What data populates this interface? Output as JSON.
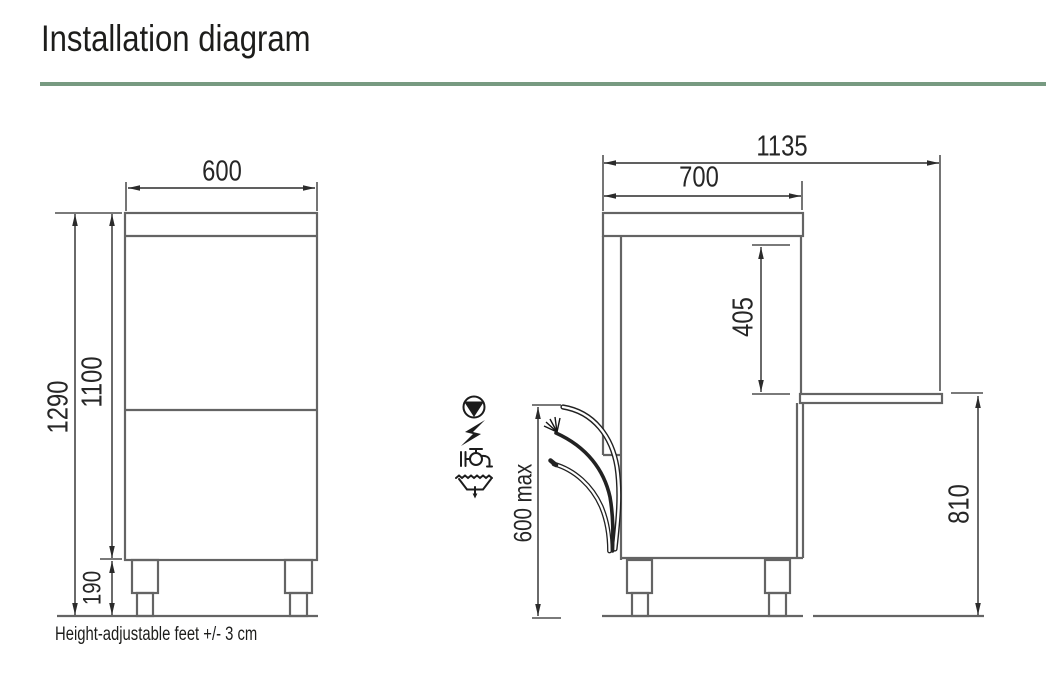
{
  "title": "Installation diagram",
  "theme": {
    "divider_color": "#779a81",
    "drawing_line_color": "#646464",
    "dimension_color": "#2b2b2b"
  },
  "front_view": {
    "width_mm": "600",
    "total_height_mm": "1290",
    "body_height_mm": "1100",
    "feet_height_mm": "190"
  },
  "side_view": {
    "total_depth_mm": "1135",
    "body_depth_mm": "700",
    "opening_height_mm": "405",
    "connections_max_height_mm": "600 max",
    "worktop_height_mm": "810"
  },
  "connections": {
    "icons": [
      "drain-pump-icon",
      "electrical-icon",
      "water-supply-icon",
      "drain-icon"
    ]
  },
  "footnote": "Height-adjustable feet +/- 3 cm"
}
